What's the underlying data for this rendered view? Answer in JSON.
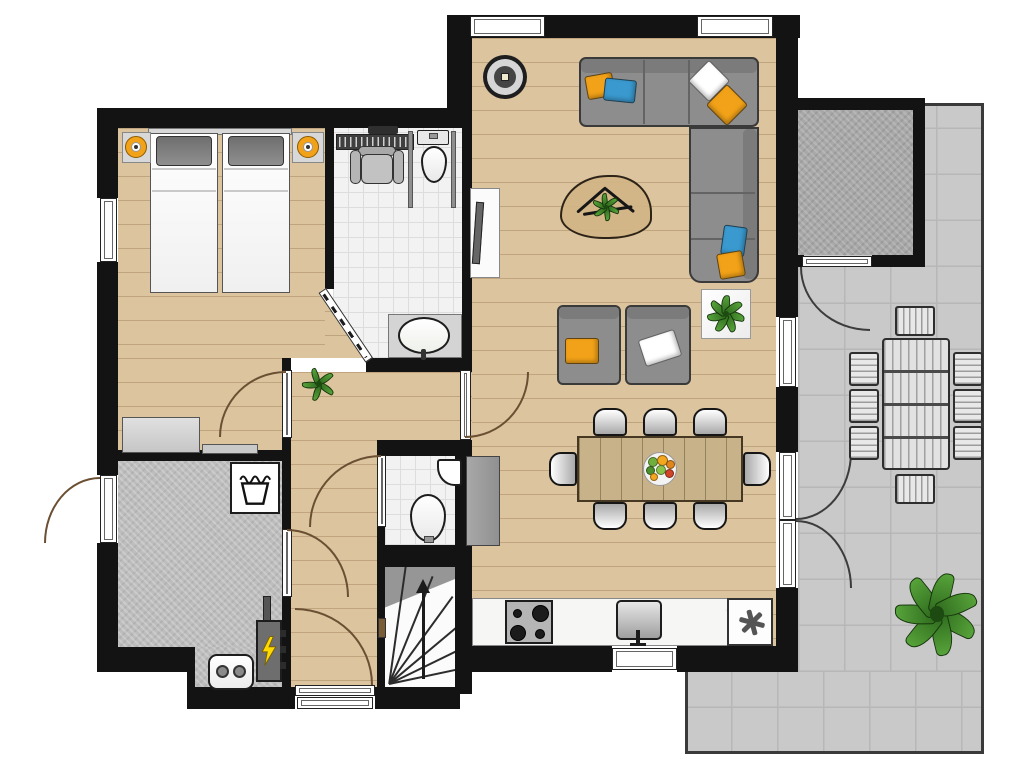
{
  "page": {
    "type": "architectural-floor-plan",
    "text_labels": []
  },
  "colors": {
    "wall": "#131313",
    "wood": "#dcc49e",
    "tile": "#f2f2f2",
    "tile-line": "#dddddd",
    "terrace": "#c9c9c9",
    "terrace-line": "#b7b7b7",
    "concrete": "#bdbdbd",
    "shed": "#a8a8a8",
    "counter": "#f6f6f4",
    "cabinet": "#9e9e9e",
    "sofa": "#8d8d8d",
    "orange": "#f2a218",
    "blue": "#3a99cf",
    "pillow-white": "#ffffff",
    "table-wood": "#c8b289",
    "arc": "#6b4f33",
    "green": "#57a33a",
    "green-dark": "#2f6b1e",
    "bolt": "#ffd900"
  },
  "rooms": [
    {
      "id": "bedroom",
      "floor": "wood",
      "features": [
        "double-bed",
        "two-gray-pillows",
        "nightstand-left",
        "nightstand-right",
        "orange-speaker-left",
        "orange-speaker-right",
        "dresser",
        "bench",
        "window-left"
      ]
    },
    {
      "id": "bathroom",
      "floor": "tile",
      "features": [
        "shower-drain",
        "shower-seat",
        "glass-partitions",
        "toilet",
        "oval-washbasin",
        "diagonal-door"
      ]
    },
    {
      "id": "living-dining",
      "floor": "wood",
      "features": [
        "corner-sofa",
        "six-sofa-pillows",
        "coffee-table",
        "branch-decor",
        "plant",
        "two-armchairs",
        "side-table-plant",
        "tv-cabinet",
        "round-speaker",
        "dining-table",
        "fruit-bowl",
        "two-top-windows",
        "right-window",
        "french-doors"
      ]
    },
    {
      "id": "kitchen",
      "floor": "wood",
      "features": [
        "counter",
        "gas-hob",
        "sink",
        "freezer-asterisk",
        "tall-cabinet",
        "bottom-window"
      ]
    },
    {
      "id": "hallway",
      "floor": "wood",
      "features": [
        "plant",
        "exit-door",
        "door-mat"
      ]
    },
    {
      "id": "wc",
      "floor": "tile",
      "features": [
        "corner-basin",
        "toilet"
      ]
    },
    {
      "id": "staircase",
      "floor": "white",
      "features": [
        "winder-steps",
        "up-arrow",
        "newel-post"
      ]
    },
    {
      "id": "utility-room",
      "floor": "concrete",
      "features": [
        "washing-machine",
        "boiler",
        "electrical-panel",
        "entry-door"
      ]
    },
    {
      "id": "storage-shed",
      "floor": "concrete",
      "features": [
        "shed-door"
      ]
    },
    {
      "id": "terrace",
      "floor": "pavement-tiles",
      "features": [
        "outdoor-table",
        "outdoor-chairs",
        "large-plant"
      ]
    }
  ],
  "counts": {
    "dining-chairs": 8,
    "outdoor-chairs": 8,
    "hob-burners": 4,
    "sofa-pillows": 6,
    "armchair-pillows": 2,
    "bed-pillows": 2,
    "windows": 5,
    "door-swings": 9
  },
  "icons": {
    "washing-machine": "laundry-tub-glyph",
    "electrical-panel": "lightning-bolt",
    "freezer": "asterisk-snowflake",
    "stairs-direction": "up-arrow"
  }
}
